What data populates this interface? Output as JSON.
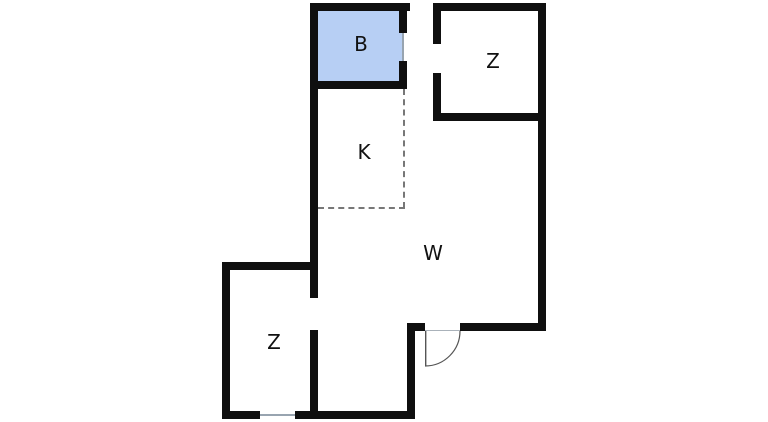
{
  "floorplan": {
    "background_color": "#ffffff",
    "wall_color": "#0f0f0f",
    "highlight_color": "#b7cff4",
    "dashed_boundary_color": "#777777",
    "window_line_color": "#98a4b0",
    "door_line_color": "#555555",
    "rooms": [
      {
        "id": "bathroom",
        "label": "B",
        "highlighted": true
      },
      {
        "id": "room-top-right",
        "label": "Z",
        "highlighted": false
      },
      {
        "id": "kitchen",
        "label": "K",
        "highlighted": false
      },
      {
        "id": "living-area",
        "label": "W",
        "highlighted": false
      },
      {
        "id": "room-bottom-left",
        "label": "Z",
        "highlighted": false
      }
    ]
  }
}
